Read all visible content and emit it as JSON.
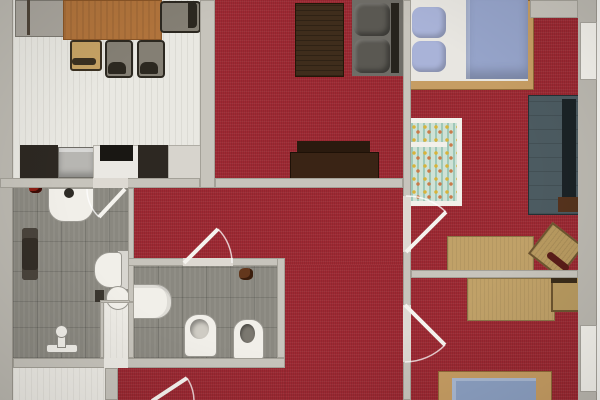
{
  "image_type": "photographed architectural floor plan, top-down, no text labels",
  "palette": {
    "red_floor": "#9e2933",
    "tile_floor": "#8a8880",
    "light_floor": "#e9e8e2",
    "white_floor": "#edebe5",
    "wall": "#c7c4bc",
    "wall_outer": "#bcb9b1",
    "door_gap": "#ddd9d2",
    "door_white": "#f5f3ee",
    "window_white": "#f4f2ec",
    "wood_table": "#b1743c",
    "wood_desk": "#c0a168",
    "bed_frame": "#c69d63",
    "mattress_blue": "#96a4ca",
    "pillow_blue": "#a9b3d8",
    "duvet_white": "#e8e6e1",
    "wardrobe_teal": "#4c5b61",
    "sofa_gray": "#6f6d67",
    "cushion_gray": "#5a5852",
    "dark_brown": "#3a2415",
    "counter_dark": "#2d2822",
    "fixture_white": "#f1efe9",
    "crib_teal": "#cfe2d6",
    "chair_gray": "#847f74",
    "accent_red_item": "#8c1f14"
  },
  "rooms": [
    {
      "id": "dining-kitchen",
      "position": "top-left",
      "floor": "light",
      "contents": [
        "gray-sideboard",
        "dining-table",
        "dining-chair x4",
        "kitchen-counter",
        "kitchen-sink",
        "cooktop"
      ]
    },
    {
      "id": "living-room",
      "position": "top-center",
      "floor": "red",
      "contents": [
        "dark-rug",
        "gray-sofa",
        "sideboard"
      ]
    },
    {
      "id": "bedroom-1",
      "position": "right-top",
      "floor": "red",
      "contents": [
        "double-bed",
        "crib",
        "wardrobe",
        "desk",
        "stool"
      ]
    },
    {
      "id": "bedroom-2",
      "position": "right-bottom",
      "floor": "red",
      "contents": [
        "desk",
        "chair",
        "bed"
      ]
    },
    {
      "id": "bathroom-1",
      "position": "left",
      "floor": "gray-tile",
      "contents": [
        "washbasin",
        "towel-radiator",
        "toilet",
        "round-basin",
        "shower-fitting"
      ]
    },
    {
      "id": "bathroom-2",
      "position": "bottom-center",
      "floor": "gray-tile",
      "contents": [
        "bathtub",
        "bidet",
        "toilet",
        "wall-hooks"
      ]
    },
    {
      "id": "hallway",
      "position": "center",
      "floor": "red",
      "contents": []
    }
  ],
  "openings": {
    "door_swings": 5,
    "windows_right_wall": 2
  }
}
